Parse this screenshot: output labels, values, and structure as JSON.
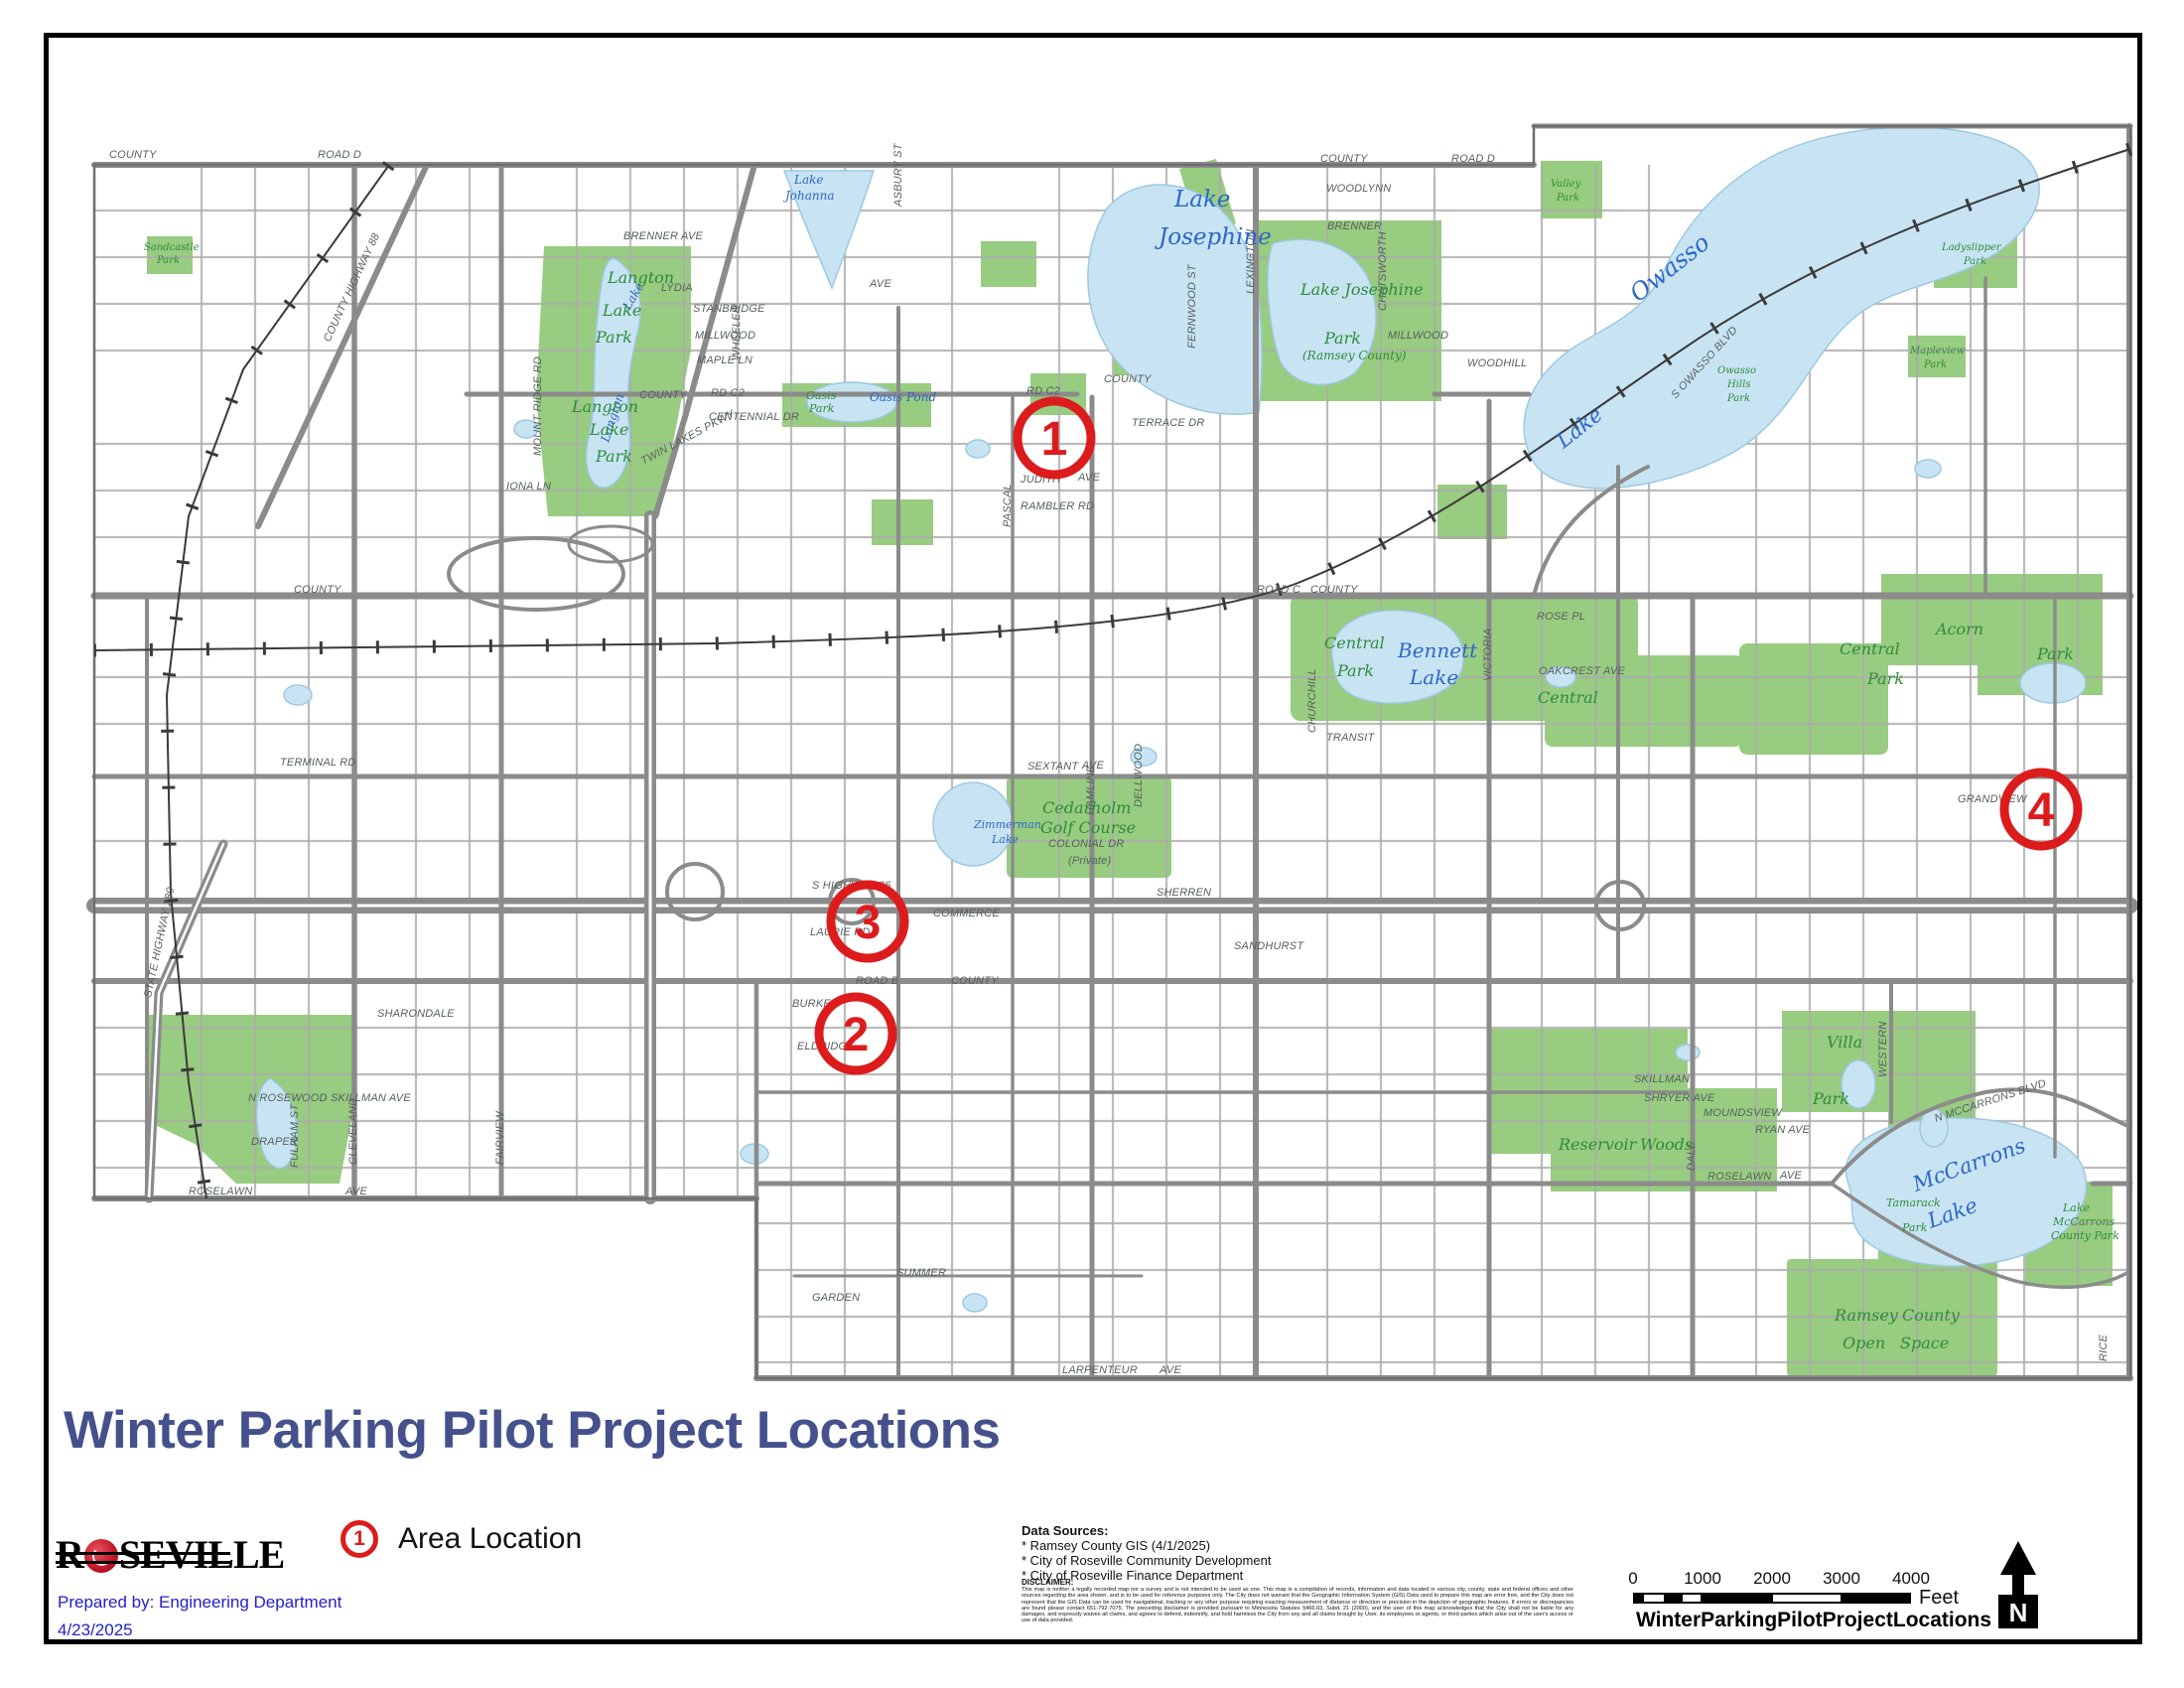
{
  "page": {
    "title": "Winter Parking Pilot Project Locations",
    "logo": {
      "text_before_rose": "R",
      "text_after_rose": "SEVILLE"
    },
    "prepared_by": "Prepared by: Engineering Department",
    "date": "4/23/2025"
  },
  "legend": {
    "marker_number": "1",
    "label": "Area Location"
  },
  "data_sources": {
    "heading": "Data Sources:",
    "items": [
      "* Ramsey County GIS (4/1/2025)",
      "* City of Roseville Community Development",
      "* City of Roseville Finance Department"
    ]
  },
  "disclaimer": {
    "heading": "DISCLAIMER:",
    "text": "This map is neither a legally recorded map nor a survey and is not intended to be used as one. This map is a compilation of records, information and data located in various city, county, state and federal offices and other sources regarding the area shown, and is to be used for reference purposes only. The City does not warrant that the Geographic Information System (GIS) Data used to prepare this map are error free, and the City does not represent that the GIS Data can be used for navigational, tracking or any other purpose requiring exacting measurement of distance or direction or precision in the depiction of geographic features. If errors or discrepancies are found please contact 651-792-7075. The preceding disclaimer is provided pursuant to Minnesota Statutes §466.03, Subd. 21 (2000), and the user of this map acknowledges that the City shall not be liable for any damages, and expressly waives all claims, and agrees to defend, indemnify, and hold harmless the City from any and all claims brought by User, its employees or agents, or third parties which arise out of the user's access or use of data provided."
  },
  "scale_bar": {
    "ticks": [
      "0",
      "1000",
      "2000",
      "3000",
      "4000"
    ],
    "unit": "Feet",
    "caption": "WinterParkingPilotProjectLocations"
  },
  "north_arrow": {
    "label": "N"
  },
  "map": {
    "colors": {
      "water": "#C8E4F3",
      "park": "#98CC80",
      "road": "#8B8B8B",
      "minor_road": "#ABABAB",
      "marker_red": "#DC1C1C",
      "title_navy": "#44518C",
      "annotation_blue": "#2121CB",
      "water_label": "#2C66C8",
      "park_label": "#2F8C3B",
      "street_label": "#55605F"
    },
    "markers": [
      {
        "number": "1"
      },
      {
        "number": "2"
      },
      {
        "number": "3"
      },
      {
        "number": "4"
      }
    ],
    "water_labels": [
      "Lake",
      "Johanna",
      "Lake",
      "Josephine",
      "Owasso",
      "Lake",
      "Bennett",
      "Lake",
      "Zimmerman",
      "Lake",
      "Oasis Pond",
      "McCarrons",
      "Lake",
      "Langton",
      "Lake"
    ],
    "park_labels": [
      "Langton",
      "Lake",
      "Park",
      "Langton",
      "Lake",
      "Park",
      "Lake Josephine",
      "Park",
      "(Ramsey County)",
      "Central",
      "Park",
      "Central",
      "Central",
      "Park",
      "Cedarholm",
      "Golf Course",
      "Acorn",
      "Park",
      "Reservoir",
      "Woods",
      "Villa",
      "Park",
      "Ramsey",
      "County",
      "Open",
      "Space",
      "Lake",
      "McCarrons",
      "County Park",
      "Tamarack",
      "Park",
      "Oasis",
      "Park",
      "Valley",
      "Park",
      "Ladyslipper",
      "Park",
      "Owasso",
      "Hills",
      "Park",
      "Mapleview",
      "Park",
      "Sandcastle",
      "Park"
    ],
    "street_labels": [
      "COUNTY",
      "ROAD D",
      "COUNTY",
      "ROAD D",
      "BRENNER AVE",
      "LYDIA",
      "AVE",
      "STANBRIDGE",
      "MILLWOOD",
      "MAPLE LN",
      "MILLWOOD",
      "WOODLYNN",
      "BRENNER",
      "COUNTY",
      "RD C2",
      "COUNTY",
      "RD C2",
      "TERRACE DR",
      "JUDITH",
      "AVE",
      "RAMBLER RD",
      "CENTENNIAL DR",
      "IONA LN",
      "TWIN LAKES PKWY",
      "ROAD C",
      "COUNTY",
      "COUNTY",
      "ROSE PL",
      "WOODHILL",
      "OAKCREST AVE",
      "TRANSIT",
      "SEXTANT",
      "AVE",
      "S HIGHWAY 36",
      "COMMERCE",
      "LAURIE RD",
      "SHERREN",
      "SANDHURST",
      "ROAD B",
      "COUNTY",
      "BURKE",
      "ELDRIDGE",
      "SKILLMAN",
      "SKILLMAN AVE",
      "SHRYER AVE",
      "RYAN AVE",
      "MOUNDSVIEW",
      "N ROSEWOOD",
      "DRAPER",
      "SHARONDALE",
      "ROSELAWN",
      "AVE",
      "ROSELAWN",
      "AVE",
      "SUMMER",
      "GARDEN",
      "LARPENTEUR",
      "AVE",
      "LEXINGTON",
      "VICTORIA",
      "DALE",
      "HAMLINE",
      "CLEVELAND",
      "FAIRVIEW",
      "WESTERN",
      "RICE",
      "FERNWOOD ST",
      "CHATSWORTH",
      "CHURCHILL",
      "ASBURY ST",
      "WHEELER",
      "PASCAL",
      "STATE HIGHWAY 280",
      "COUNTY HIGHWAY 88",
      "N MCCARRONS BLVD",
      "S OWASSO BLVD",
      "GRANDVIEW",
      "DELLWOOD",
      "COLONIAL DR",
      "(Private)",
      "MOUNT RIDGE RD",
      "TERMINAL RD",
      "FULHAM ST"
    ]
  }
}
